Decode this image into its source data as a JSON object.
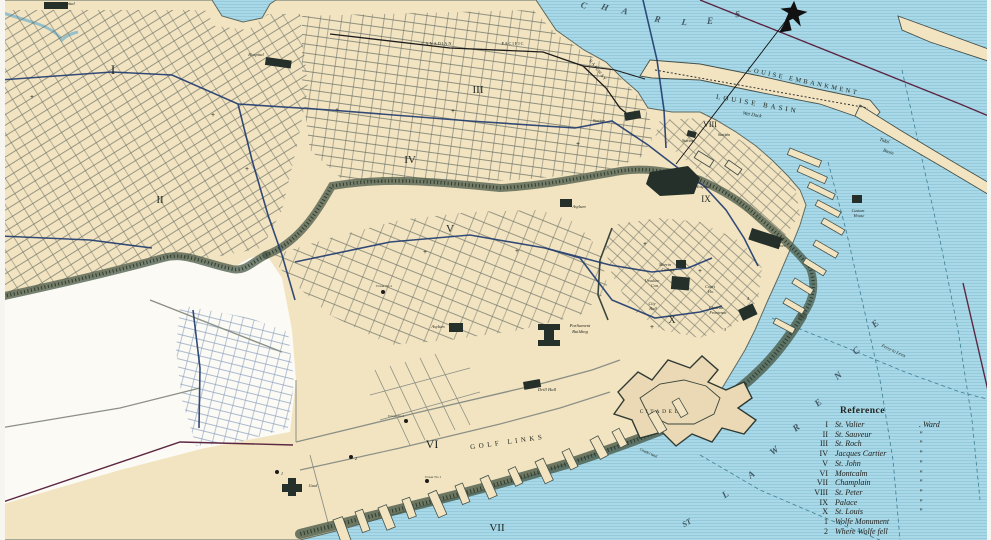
{
  "colors": {
    "water": "#a9d9e8",
    "water_lines": "#8cc4d6",
    "land": "#f3e4c1",
    "blank_area": "#fbfaf4",
    "tram_line": "#1e3a6e",
    "boundary_line": "#5c2742",
    "trees": "#3d4c40",
    "railway": "#1c1c1c"
  },
  "legend": {
    "title": "Reference",
    "rows": [
      {
        "num": "I",
        "name": "St. Valier",
        "suf": ". Ward"
      },
      {
        "num": "II",
        "name": "St. Sauveur",
        "suf": "\""
      },
      {
        "num": "III",
        "name": "St. Roch",
        "suf": "\""
      },
      {
        "num": "IV",
        "name": "Jacques Cartier",
        "suf": "\""
      },
      {
        "num": "V",
        "name": "St. John",
        "suf": "\""
      },
      {
        "num": "VI",
        "name": "Montcalm",
        "suf": "\""
      },
      {
        "num": "VII",
        "name": "Champlain",
        "suf": "\""
      },
      {
        "num": "VIII",
        "name": "St. Peter",
        "suf": "\""
      },
      {
        "num": "IX",
        "name": "Palace",
        "suf": "\""
      },
      {
        "num": "X",
        "name": "St. Louis",
        "suf": "\""
      },
      {
        "num": "1",
        "name": "Wolfe Monument",
        "suf": ""
      },
      {
        "num": "2",
        "name": "Where Wolfe fell",
        "suf": ""
      }
    ]
  },
  "map": {
    "labels": [
      {
        "t": "Hospital",
        "x": 67,
        "y": 5,
        "s": 4.5,
        "c": "i"
      },
      {
        "t": "Hospital",
        "x": 256,
        "y": 56,
        "s": 4.5,
        "c": "i"
      },
      {
        "t": "Hospital",
        "x": 703,
        "y": 188,
        "s": 4.5,
        "c": "i"
      },
      {
        "t": "Asylum",
        "x": 579,
        "y": 208,
        "s": 4.5,
        "c": "i"
      },
      {
        "t": "Asylum",
        "x": 438,
        "y": 328,
        "s": 4.5,
        "c": "i"
      },
      {
        "t": "I",
        "x": 113,
        "y": 74,
        "s": 13,
        "c": "ward"
      },
      {
        "t": "II",
        "x": 160,
        "y": 203,
        "s": 11,
        "c": "ward"
      },
      {
        "t": "III",
        "x": 478,
        "y": 93,
        "s": 11,
        "c": "ward"
      },
      {
        "t": "IV",
        "x": 410,
        "y": 163,
        "s": 11,
        "c": "ward"
      },
      {
        "t": "V",
        "x": 450,
        "y": 232,
        "s": 11,
        "c": "ward"
      },
      {
        "t": "VI",
        "x": 432,
        "y": 448,
        "s": 12,
        "c": "ward"
      },
      {
        "t": "VII",
        "x": 497,
        "y": 531,
        "s": 11,
        "c": "ward"
      },
      {
        "t": "VIII",
        "x": 710,
        "y": 127,
        "s": 8,
        "c": "ward"
      },
      {
        "t": "IX",
        "x": 706,
        "y": 202,
        "s": 9,
        "c": "ward"
      },
      {
        "t": "X",
        "x": 672,
        "y": 323,
        "s": 10,
        "c": "ward"
      },
      {
        "t": "CANADIAN",
        "x": 437,
        "y": 45,
        "s": 4.3,
        "ls": 1
      },
      {
        "t": "PACIFIC",
        "x": 513,
        "y": 45,
        "s": 4.3,
        "ls": 1
      },
      {
        "t": "RAILWAY",
        "x": 597,
        "y": 71,
        "s": 4.3,
        "r": 52,
        "ls": 1
      },
      {
        "t": "Station",
        "x": 599,
        "y": 122,
        "s": 4.3,
        "c": "i"
      },
      {
        "t": "Station",
        "x": 688,
        "y": 142,
        "s": 4.3,
        "c": "i"
      },
      {
        "t": "Station",
        "x": 724,
        "y": 136,
        "s": 4.3,
        "c": "i"
      },
      {
        "t": "LOUISE EMBANKMENT",
        "x": 803,
        "y": 83,
        "s": 6.5,
        "r": 12,
        "ls": 2.5
      },
      {
        "t": "LOUISE BASIN",
        "x": 757,
        "y": 106,
        "s": 7,
        "r": 10,
        "ls": 3
      },
      {
        "t": "Wet Dock",
        "x": 752,
        "y": 116,
        "s": 5,
        "r": 10,
        "c": "i"
      },
      {
        "t": "Tidal",
        "x": 884,
        "y": 142,
        "s": 4.8,
        "r": 18,
        "c": "i"
      },
      {
        "t": "Basin",
        "x": 888,
        "y": 153,
        "s": 4.8,
        "r": 18,
        "c": "i"
      },
      {
        "t": "Morrin",
        "x": 665,
        "y": 266,
        "s": 4.2,
        "c": "i"
      },
      {
        "t": "College",
        "x": 668,
        "y": 271,
        "s": 4.2,
        "c": "i"
      },
      {
        "t": "Ursuline",
        "x": 652,
        "y": 282,
        "s": 4.2,
        "c": "i"
      },
      {
        "t": "Con.",
        "x": 655,
        "y": 287,
        "s": 4.2,
        "c": "i"
      },
      {
        "t": "City",
        "x": 652,
        "y": 305,
        "s": 4.2,
        "c": "i"
      },
      {
        "t": "Hall",
        "x": 653,
        "y": 310,
        "s": 4.2,
        "c": "i"
      },
      {
        "t": "Court",
        "x": 710,
        "y": 288,
        "s": 4.2,
        "c": "i"
      },
      {
        "t": "Ho.",
        "x": 711,
        "y": 293,
        "s": 4.2,
        "c": "i"
      },
      {
        "t": "Chateau",
        "x": 716,
        "y": 309,
        "s": 4.2,
        "c": "i"
      },
      {
        "t": "Frontenac",
        "x": 718,
        "y": 314,
        "s": 4.2,
        "c": "i"
      },
      {
        "t": "Laval",
        "x": 778,
        "y": 241,
        "s": 4.4,
        "c": "i"
      },
      {
        "t": "Univer.",
        "x": 780,
        "y": 247,
        "s": 4.4,
        "c": "i"
      },
      {
        "t": "Parliament",
        "x": 580,
        "y": 327,
        "s": 4.6,
        "c": "i"
      },
      {
        "t": "Building",
        "x": 580,
        "y": 333,
        "s": 4.6,
        "c": "i"
      },
      {
        "t": "Drill Hall",
        "x": 547,
        "y": 391,
        "s": 4.6,
        "c": "i"
      },
      {
        "t": "CITADEL",
        "x": 660,
        "y": 413,
        "s": 5.5,
        "ls": 2.5
      },
      {
        "t": "Citadel Wall",
        "x": 648,
        "y": 454,
        "s": 3.8,
        "r": 25,
        "c": "i"
      },
      {
        "t": "GOLF LINKS",
        "x": 508,
        "y": 444,
        "s": 7,
        "r": -8,
        "ls": 3.5
      },
      {
        "t": "Gaol",
        "x": 313,
        "y": 487,
        "s": 4.4,
        "c": "i"
      },
      {
        "t": "Custom",
        "x": 858,
        "y": 212,
        "s": 4.2,
        "c": "i"
      },
      {
        "t": "House",
        "x": 859,
        "y": 217,
        "s": 4.2,
        "c": "i"
      },
      {
        "t": "Ferry to Levis",
        "x": 893,
        "y": 352,
        "s": 4.6,
        "r": 25,
        "c": "i"
      },
      {
        "t": "Tower No 2",
        "x": 384,
        "y": 287,
        "s": 3.4
      },
      {
        "t": "Tower No 1",
        "x": 433,
        "y": 478,
        "s": 3.4
      },
      {
        "t": "Tower No 4",
        "x": 396,
        "y": 417,
        "s": 3.4
      },
      {
        "t": "1",
        "x": 282,
        "y": 475,
        "s": 4.5,
        "c": "i"
      },
      {
        "t": "2",
        "x": 356,
        "y": 460,
        "s": 4.5,
        "c": "i"
      },
      {
        "t": "3",
        "x": 725,
        "y": 331,
        "s": 4.5,
        "c": "i"
      },
      {
        "t": "4",
        "x": 748,
        "y": 300,
        "s": 4.5,
        "c": "i"
      },
      {
        "t": "C",
        "x": 583,
        "y": 8,
        "s": 9,
        "r": 18,
        "c": "riv"
      },
      {
        "t": "H",
        "x": 604,
        "y": 10,
        "s": 9,
        "r": 18,
        "c": "riv"
      },
      {
        "t": "A",
        "x": 624,
        "y": 14,
        "s": 9,
        "r": 16,
        "c": "riv"
      },
      {
        "t": "R",
        "x": 657,
        "y": 22,
        "s": 9,
        "r": 12,
        "c": "riv"
      },
      {
        "t": "L",
        "x": 684,
        "y": 25,
        "s": 9,
        "r": 8,
        "c": "riv"
      },
      {
        "t": "E",
        "x": 710,
        "y": 24,
        "s": 9,
        "c": "riv"
      },
      {
        "t": "S",
        "x": 738,
        "y": 17,
        "s": 9,
        "r": -8,
        "c": "riv"
      },
      {
        "t": "ST",
        "x": 688,
        "y": 525,
        "s": 8,
        "r": -30,
        "c": "riv"
      },
      {
        "t": "L",
        "x": 727,
        "y": 497,
        "s": 9.5,
        "r": -35,
        "c": "riv"
      },
      {
        "t": "A",
        "x": 753,
        "y": 477,
        "s": 9.5,
        "r": -36,
        "c": "riv"
      },
      {
        "t": "W",
        "x": 776,
        "y": 453,
        "s": 9.5,
        "r": -38,
        "c": "riv"
      },
      {
        "t": "R",
        "x": 798,
        "y": 430,
        "s": 9.5,
        "r": -38,
        "c": "riv"
      },
      {
        "t": "E",
        "x": 820,
        "y": 405,
        "s": 9.5,
        "r": -40,
        "c": "riv"
      },
      {
        "t": "N",
        "x": 840,
        "y": 378,
        "s": 9.5,
        "r": -40,
        "c": "riv"
      },
      {
        "t": "C",
        "x": 858,
        "y": 353,
        "s": 9.5,
        "r": -40,
        "c": "riv"
      },
      {
        "t": "E",
        "x": 877,
        "y": 326,
        "s": 9.5,
        "r": -40,
        "c": "riv"
      }
    ],
    "dots": [
      {
        "x": 277,
        "y": 472,
        "n": "wolfe-monument-dot"
      },
      {
        "x": 351,
        "y": 457,
        "n": "wolfe-fell-dot"
      },
      {
        "x": 383,
        "y": 292,
        "n": "martello-tower-2-dot"
      },
      {
        "x": 427,
        "y": 481,
        "n": "martello-tower-1-dot"
      },
      {
        "x": 406,
        "y": 421,
        "n": "martello-tower-4-dot"
      }
    ],
    "crosses": [
      [
        32,
        99
      ],
      [
        213,
        117
      ],
      [
        247,
        171
      ],
      [
        337,
        112
      ],
      [
        453,
        113
      ],
      [
        425,
        254
      ],
      [
        517,
        253
      ],
      [
        645,
        246
      ],
      [
        700,
        273
      ],
      [
        652,
        329
      ],
      [
        578,
        146
      ],
      [
        857,
        200
      ]
    ]
  }
}
